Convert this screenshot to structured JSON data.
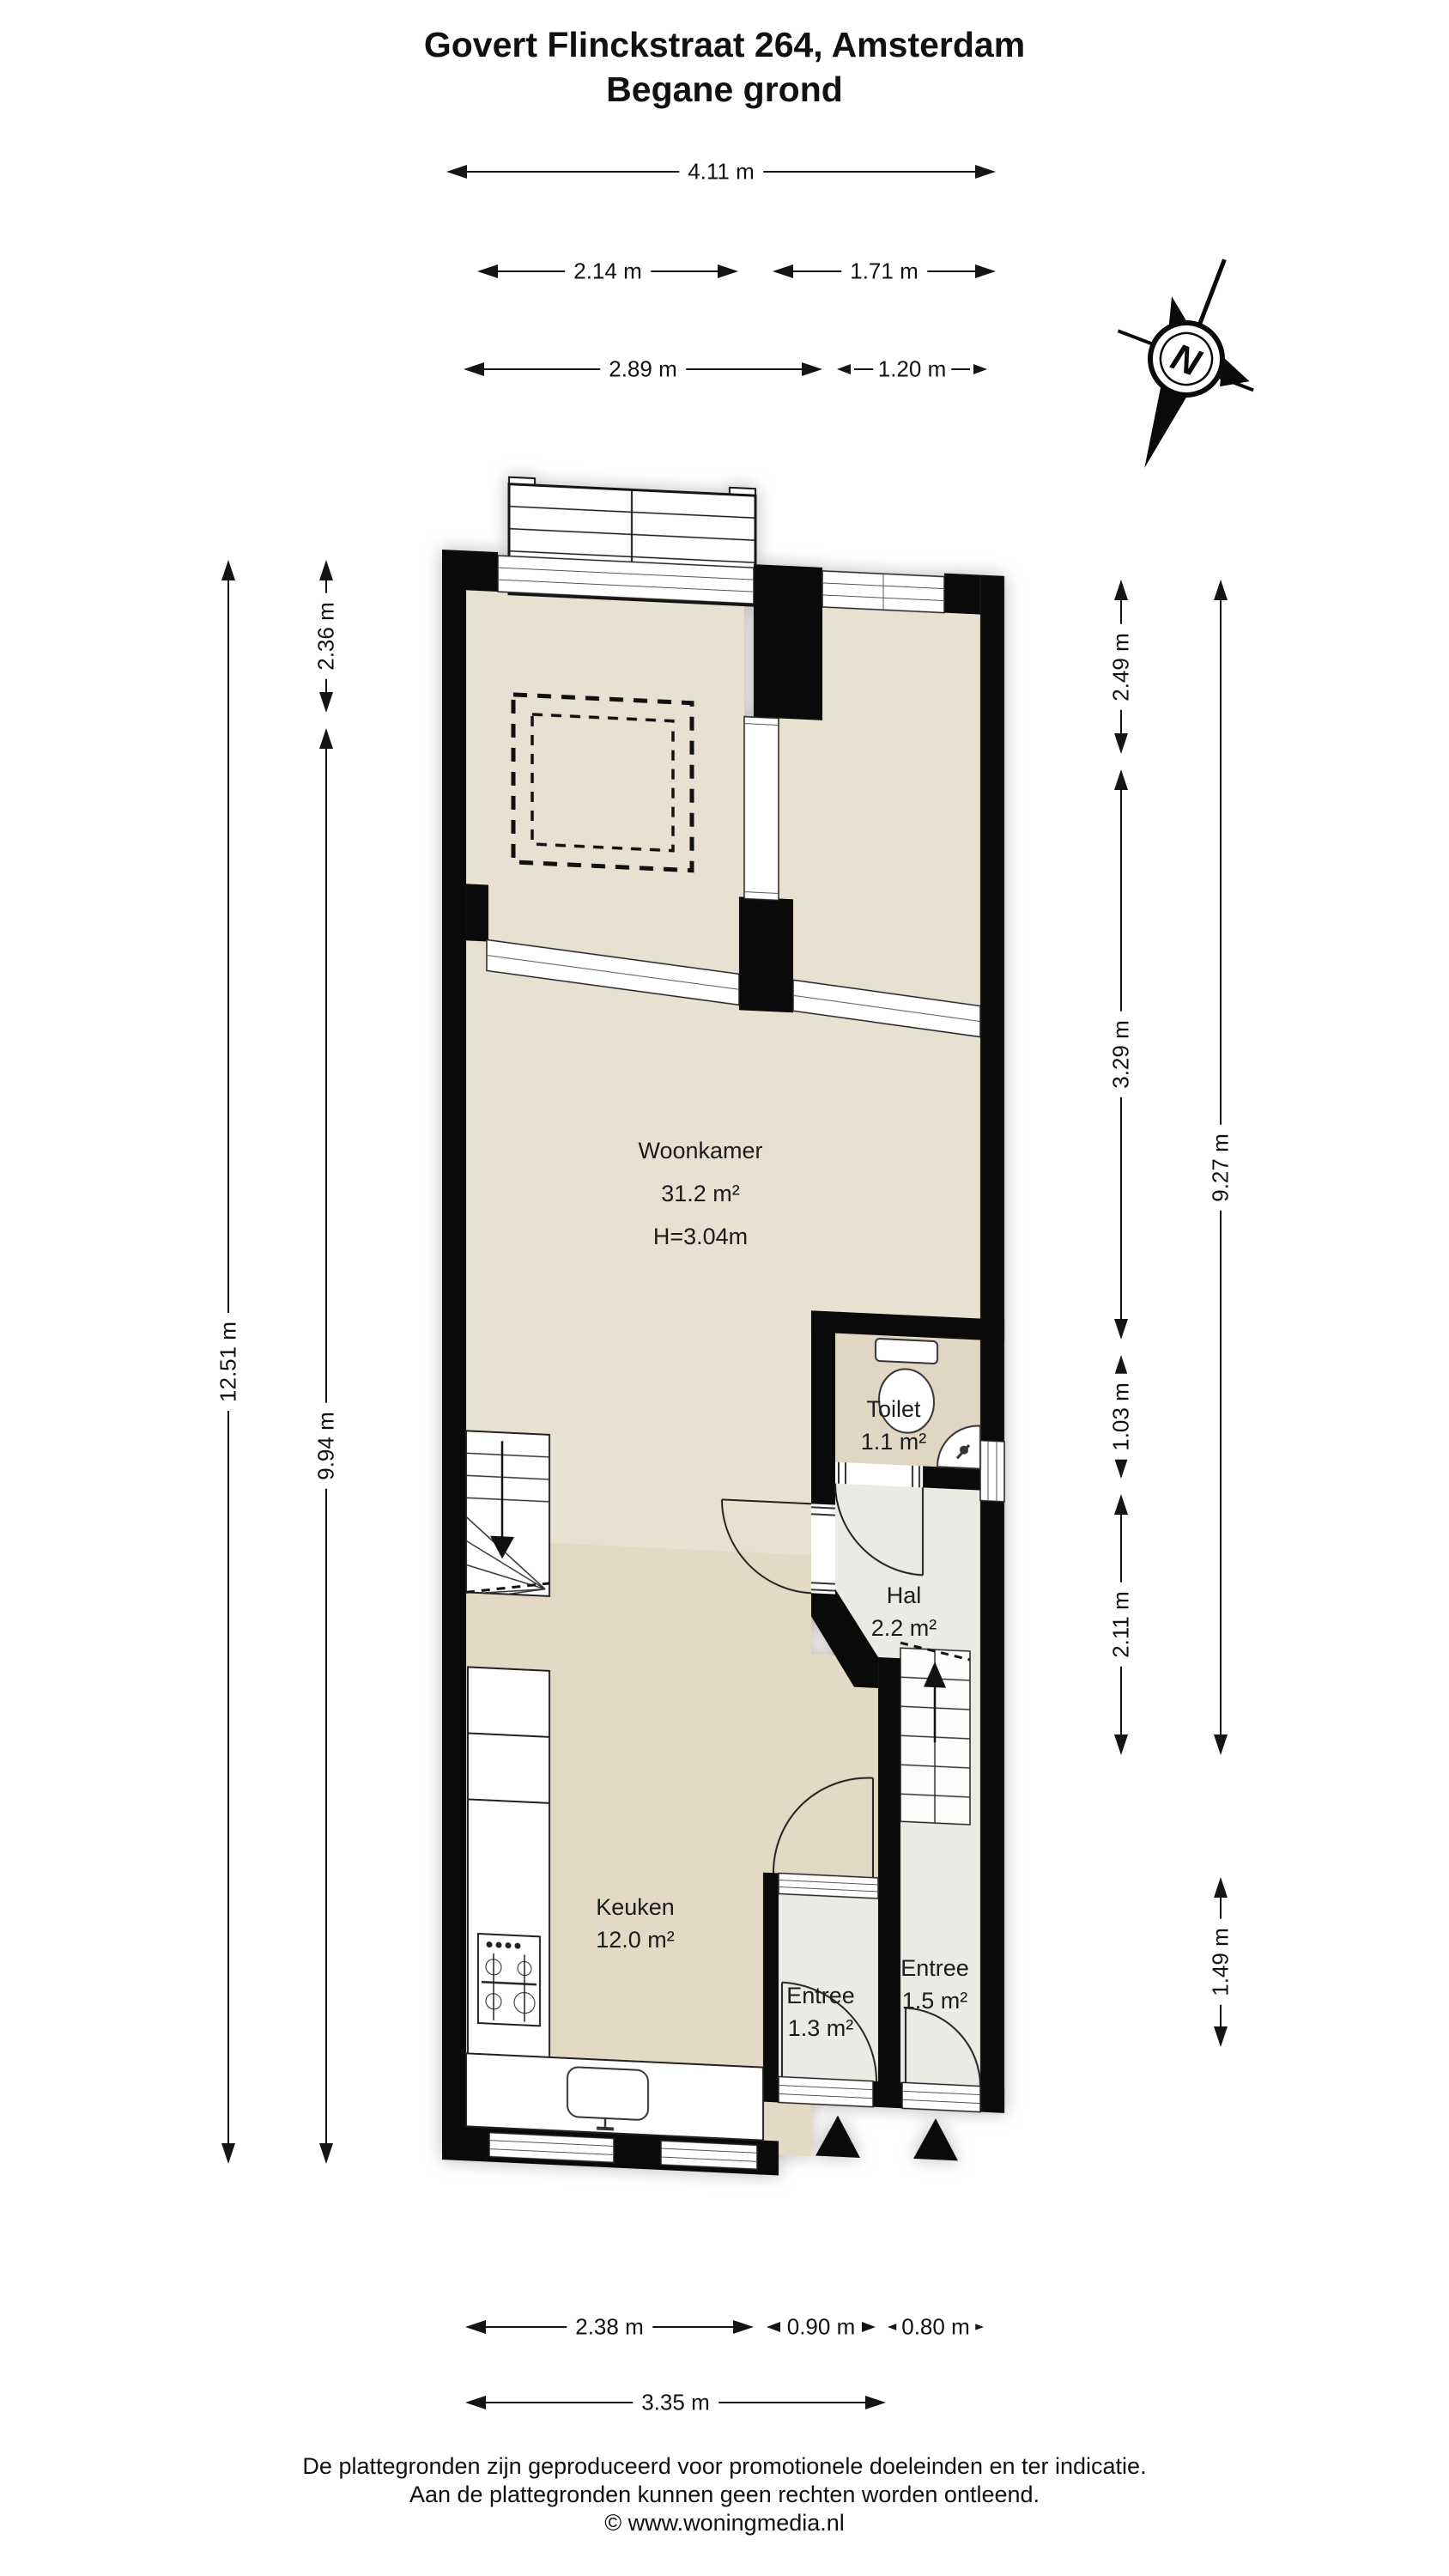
{
  "title": {
    "line1": "Govert Flinckstraat 264, Amsterdam",
    "line2": "Begane grond"
  },
  "compass": {
    "label": "N"
  },
  "rooms": {
    "woonkamer": {
      "name": "Woonkamer",
      "area": "31.2 m²",
      "height": "H=3.04m"
    },
    "toilet": {
      "name": "Toilet",
      "area": "1.1 m²"
    },
    "hal": {
      "name": "Hal",
      "area": "2.2 m²"
    },
    "keuken": {
      "name": "Keuken",
      "area": "12.0 m²"
    },
    "entree1": {
      "name": "Entree",
      "area": "1.3 m²"
    },
    "entree2": {
      "name": "Entree",
      "area": "1.5 m²"
    }
  },
  "dimensions": {
    "top": [
      "4.11 m",
      "2.14 m",
      "1.71 m",
      "2.89 m",
      "1.20 m"
    ],
    "left": [
      "12.51 m",
      "2.36 m",
      "9.94 m"
    ],
    "right": [
      "2.49 m",
      "3.29 m",
      "1.03 m",
      "2.11 m",
      "9.27 m",
      "1.49 m"
    ],
    "bottom": [
      "2.38 m",
      "0.90 m",
      "0.80 m",
      "3.35 m"
    ]
  },
  "footer": {
    "line1": "De plattegronden zijn geproduceerd voor promotionele doeleinden en ter indicatie.",
    "line2": "Aan de plattegronden kunnen geen rechten worden ontleend.",
    "line3": "© www.woningmedia.nl"
  },
  "colors": {
    "wall": "#0a0a0a",
    "floor_living": "#e8e0d1",
    "floor_kitchen": "#e3d9c4",
    "floor_toilet": "#e0d6c3",
    "floor_hall": "#ebeae4",
    "line": "#2a2a2a"
  }
}
